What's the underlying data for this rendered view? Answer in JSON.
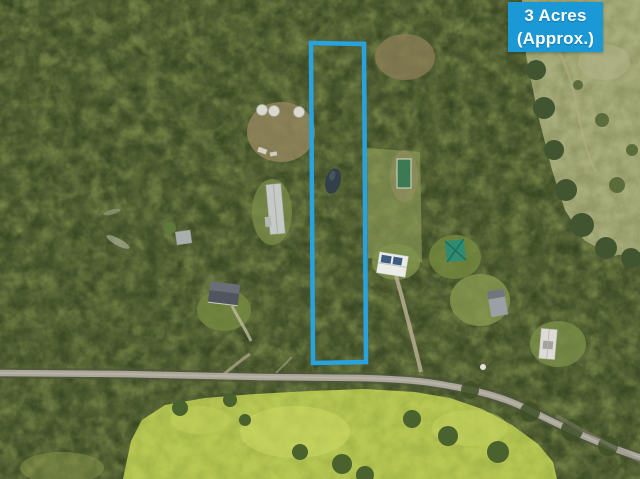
{
  "badge": {
    "line1": "3 Acres",
    "line2": "(Approx.)"
  },
  "colors": {
    "badge-bg": "#1b99d7",
    "badge-text": "#ffffff",
    "boundary": "#29a3e0"
  }
}
